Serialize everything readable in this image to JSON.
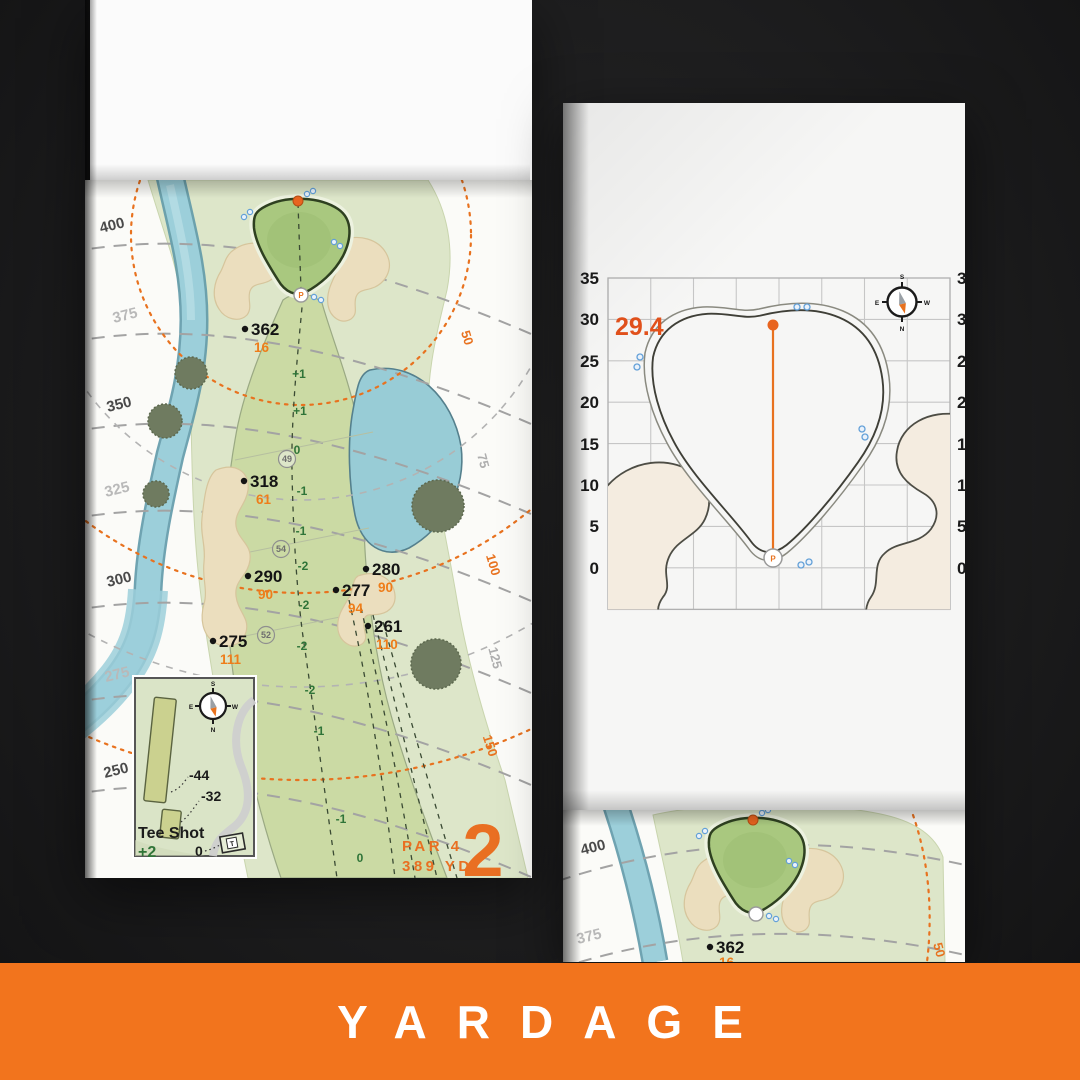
{
  "banner": {
    "title": "YARDAGE"
  },
  "hole_page": {
    "hole_number": "2",
    "par_label": "PAR 4",
    "yardage_label": "389 YD",
    "tee_arc_labels": [
      "400",
      "375",
      "350",
      "325",
      "300",
      "275",
      "250"
    ],
    "green_arc_labels": [
      "50",
      "75",
      "100",
      "125",
      "150"
    ],
    "markers": [
      {
        "yards": "362",
        "to_carry": "16"
      },
      {
        "yards": "318",
        "to_carry": "61"
      },
      {
        "yards": "290",
        "to_carry": "90"
      },
      {
        "yards": "280",
        "to_carry": "90"
      },
      {
        "yards": "277",
        "to_carry": "94"
      },
      {
        "yards": "261",
        "to_carry": "110"
      },
      {
        "yards": "275",
        "to_carry": "111"
      }
    ],
    "elevation_labels": [
      "+1",
      "+1",
      "0",
      "-1",
      "-1",
      "-2",
      "-2",
      "-2",
      "-2",
      "-1",
      "-1",
      "0"
    ],
    "circled_labels": [
      "49",
      "54",
      "52"
    ],
    "pin_label": "P",
    "tee_inset": {
      "title": "Tee Shot",
      "elevation_value": "+2",
      "zero_label": "0",
      "back_tee_offset": "-44",
      "front_tee_offset": "-32",
      "tee_marker": "T"
    },
    "compass": {
      "north": "N",
      "south": "S",
      "east": "E",
      "west": "W"
    }
  },
  "green_page": {
    "depth_value": "29.4",
    "axis_labels_left": [
      "35",
      "30",
      "25",
      "20",
      "15",
      "10",
      "5",
      "0"
    ],
    "axis_labels_right": [
      "35",
      "30",
      "25",
      "20",
      "15",
      "10",
      "5",
      "0"
    ],
    "pin_label": "P"
  },
  "continuation_page": {
    "tee_arc_labels": [
      "400",
      "375"
    ],
    "marker": {
      "yards": "362",
      "to_carry": "16"
    },
    "green_arc_label": "50"
  },
  "colors": {
    "background": "#1d1d1e",
    "banner": "#f2741d",
    "accent_orange": "#e96f22",
    "carry_orange": "#ee7d1a",
    "elevation_green": "#2f7438",
    "water": "#98ccd6",
    "sand": "#ebdebe",
    "fairway": "#cbdaa4",
    "rough": "#dde6c9",
    "putting_green": "#a9c87f",
    "tree": "#6f7b60",
    "grid_line": "#c6c6c6"
  }
}
